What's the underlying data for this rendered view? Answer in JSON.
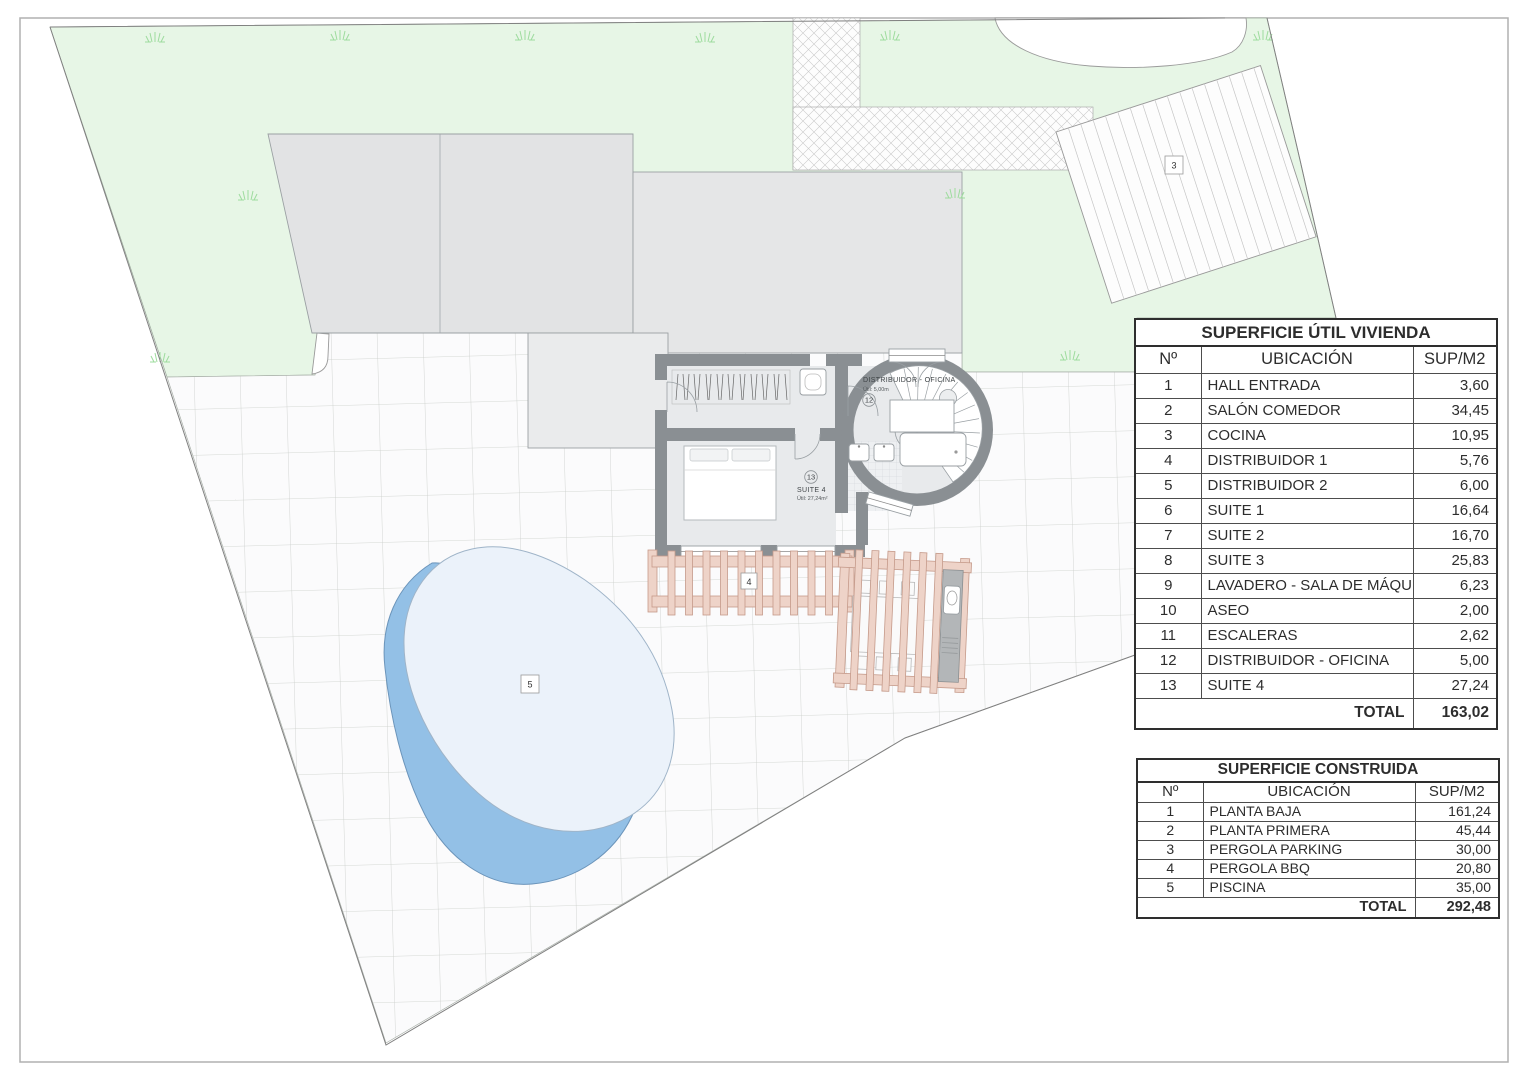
{
  "colors": {
    "lawn": "#e7f6e6",
    "roof_a": "#e2e3e4",
    "roof_b": "#e5e6e7",
    "roof_c": "#eaebec",
    "wall": "#8a8f93",
    "floor": "#e8eaec",
    "wood": "#eed3c8",
    "wood_stroke": "#c59a8a",
    "counter": "#b3b6b8",
    "pool_deep": "#93c0e6",
    "pool_deep_stroke": "#6b94ba",
    "pool_light": "#ebf2fa",
    "grass": "#9edc9e",
    "boundary": "#808080"
  },
  "plan": {
    "tower": {
      "name": "DISTRIBUIDOR - OFICINA",
      "area": "Útil: 5,00m",
      "number": "12"
    },
    "suite": {
      "name": "SUITE 4",
      "area": "Útil: 27,24m²",
      "number": "13"
    },
    "markers": {
      "parking": "3",
      "pergola": "4",
      "pool": "5"
    }
  },
  "tables": {
    "util": {
      "title": "SUPERFICIE ÚTIL VIVIENDA",
      "columns": {
        "no": "Nº",
        "ubicacion": "UBICACIÓN",
        "sup": "SUP/M2"
      },
      "rows": [
        {
          "no": "1",
          "ubicacion": "HALL ENTRADA",
          "sup": "3,60"
        },
        {
          "no": "2",
          "ubicacion": "SALÓN COMEDOR",
          "sup": "34,45"
        },
        {
          "no": "3",
          "ubicacion": "COCINA",
          "sup": "10,95"
        },
        {
          "no": "4",
          "ubicacion": "DISTRIBUIDOR 1",
          "sup": "5,76"
        },
        {
          "no": "5",
          "ubicacion": "DISTRIBUIDOR 2",
          "sup": "6,00"
        },
        {
          "no": "6",
          "ubicacion": "SUITE 1",
          "sup": "16,64"
        },
        {
          "no": "7",
          "ubicacion": "SUITE 2",
          "sup": "16,70"
        },
        {
          "no": "8",
          "ubicacion": "SUITE 3",
          "sup": "25,83"
        },
        {
          "no": "9",
          "ubicacion": "LAVADERO - SALA DE MÁQUINAS",
          "sup": "6,23"
        },
        {
          "no": "10",
          "ubicacion": "ASEO",
          "sup": "2,00"
        },
        {
          "no": "11",
          "ubicacion": "ESCALERAS",
          "sup": "2,62"
        },
        {
          "no": "12",
          "ubicacion": "DISTRIBUIDOR - OFICINA",
          "sup": "5,00"
        },
        {
          "no": "13",
          "ubicacion": "SUITE 4",
          "sup": "27,24"
        }
      ],
      "total_label": "TOTAL",
      "total_value": "163,02"
    },
    "construida": {
      "title": "SUPERFICIE CONSTRUIDA",
      "columns": {
        "no": "Nº",
        "ubicacion": "UBICACIÓN",
        "sup": "SUP/M2"
      },
      "rows": [
        {
          "no": "1",
          "ubicacion": "PLANTA BAJA",
          "sup": "161,24"
        },
        {
          "no": "2",
          "ubicacion": "PLANTA PRIMERA",
          "sup": "45,44"
        },
        {
          "no": "3",
          "ubicacion": "PERGOLA PARKING",
          "sup": "30,00"
        },
        {
          "no": "4",
          "ubicacion": "PERGOLA BBQ",
          "sup": "20,80"
        },
        {
          "no": "5",
          "ubicacion": "PISCINA",
          "sup": "35,00"
        }
      ],
      "total_label": "TOTAL",
      "total_value": "292,48"
    }
  }
}
